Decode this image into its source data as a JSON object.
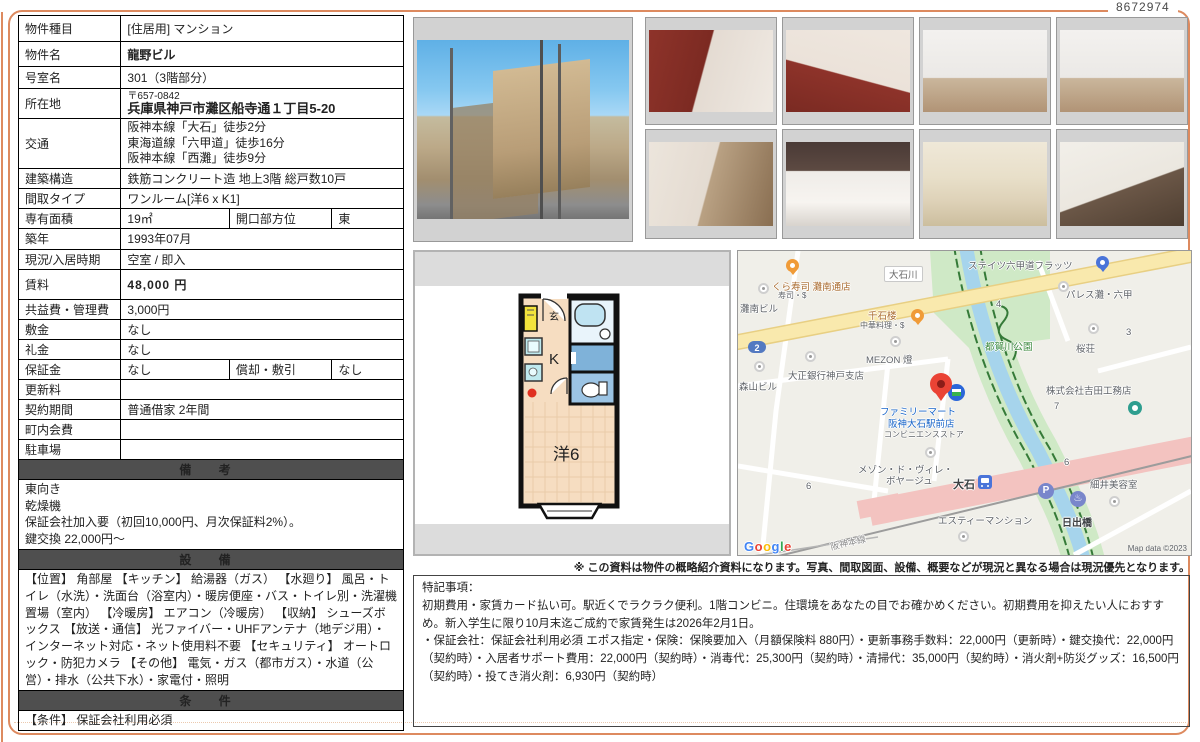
{
  "doc_number": "8672974",
  "property": {
    "type_label": "物件種目",
    "type_value": "[住居用] マンション",
    "name_label": "物件名",
    "name_value": "龍野ビル",
    "room_label": "号室名",
    "room_value": "301（3階部分）",
    "address_label": "所在地",
    "postal": "〒657-0842",
    "address": "兵庫県神戸市灘区船寺通１丁目5-20",
    "access_label": "交通",
    "access_lines": [
      "阪神本線「大石」徒歩2分",
      "東海道線「六甲道」徒歩16分",
      "阪神本線「西灘」徒歩9分"
    ],
    "structure_label": "建築構造",
    "structure_value": "鉄筋コンクリート造 地上3階 総戸数10戸",
    "layout_label": "間取タイプ",
    "layout_value": "ワンルーム[洋6 x K1]",
    "area_label": "専有面積",
    "area_value": "19㎡",
    "facing_label": "開口部方位",
    "facing_value": "東",
    "built_label": "築年",
    "built_value": "1993年07月",
    "status_label": "現況/入居時期",
    "status_value": "空室 / 即入",
    "rent_label": "賃料",
    "rent_value": "48,000 円",
    "fee_label": "共益費・管理費",
    "fee_value": "3,000円",
    "deposit_label": "敷金",
    "deposit_value": "なし",
    "key_money_label": "礼金",
    "key_money_value": "なし",
    "guarantee_label": "保証金",
    "guarantee_value": "なし",
    "amortization_label": "償却・敷引",
    "amortization_value": "なし",
    "renewal_label": "更新料",
    "renewal_value": "",
    "contract_label": "契約期間",
    "contract_value": "普通借家 2年間",
    "association_label": "町内会費",
    "association_value": "",
    "parking_label": "駐車場",
    "parking_value": ""
  },
  "remarks": {
    "title": "備 考",
    "lines": [
      "東向き",
      "乾燥機",
      "保証会社加入要（初回10,000円、月次保証料2%）。",
      "鍵交換 22,000円〜"
    ]
  },
  "equipment": {
    "title": "設 備",
    "text": "【位置】 角部屋 【キッチン】 給湯器（ガス） 【水廻り】 風呂・トイレ（水洗）・洗面台（浴室内）・暖房便座・バス・トイレ別・洗濯機置場（室内） 【冷暖房】 エアコン（冷暖房） 【収納】 シューズボックス 【放送・通信】 光ファイバー・UHFアンテナ（地デジ用）・インターネット対応・ネット使用料不要 【セキュリティ】 オートロック・防犯カメラ 【その他】 電気・ガス（都市ガス）・水道（公営）・排水（公共下水）・家電付・照明"
  },
  "conditions": {
    "title": "条 件",
    "text": "【条件】 保証会社利用必須"
  },
  "disclaimer": "※ この資料は物件の概略紹介資料になります。写真、間取図面、設備、概要などが現況と異なる場合は現況優先となります。",
  "special_notes": {
    "title": "特記事項：",
    "line1": "初期費用・家賃カード払い可。駅近くでラクラク便利。1階コンビニ。住環境をあなたの目でお確かめください。初期費用を抑えたい人におすすめ。新入学生に限り10月末迄ご成約で家賃発生は2026年2月1日。",
    "line2": "・保証会社：保証会社利用必須 エポス指定・保険：保険要加入（月額保険料 880円）・更新事務手数料：22,000円（更新時）・鍵交換代：22,000円（契約時）・入居者サポート費用：22,000円（契約時）・消毒代：25,300円（契約時）・清掃代：35,000円（契約時）・消火剤+防災グッズ：16,500円（契約時）・投てき消火剤：6,930円（契約時）"
  },
  "floorplan": {
    "entrance": "玄",
    "kitchen": "K",
    "room": "洋6"
  },
  "map": {
    "kurazushi": "くら寿司 灘南通店",
    "kurazushi_sub": "寿司・$",
    "nadaminami": "灘南ビル",
    "oishigawa": "大石川",
    "states": "ステイツ六甲道フラッツ",
    "palace": "パレス灘・六甲",
    "sengokuro": "千石楼",
    "sengokuro_sub": "中華料理・$",
    "mezon": "MEZON 燈",
    "taisho_bank": "大正銀行神戸支店",
    "moriyama": "森山ビル",
    "park": "都賀川公園",
    "sakuraso": "桜荘",
    "yoshida": "株式会社吉田工務店",
    "familymart1": "ファミリーマート",
    "familymart2": "阪神大石駅前店",
    "familymart3": "コンビニエンスストア",
    "maison1": "メゾン・ド・ヴィレ・",
    "maison2": "ボヤージュ",
    "station": "大石",
    "hosoi": "細井美容室",
    "esty": "エスティーマンション",
    "hinode": "日出橋",
    "hanshin_line": "阪神本線",
    "num2": "2",
    "num3": "3",
    "num4": "4",
    "num6a": "6",
    "num6b": "6",
    "num7": "7",
    "google_letters": [
      "G",
      "o",
      "o",
      "g",
      "l",
      "e"
    ],
    "attribution": "Map data ©2023",
    "icons": {
      "parking": "P",
      "onsen": "♨"
    },
    "colors": {
      "road_main": "#f9e9ad",
      "river": "#a6d4ec",
      "park": "#cfe9c6",
      "station_area": "#f3c3c0",
      "accent_frame": "#dd8a5f"
    }
  }
}
